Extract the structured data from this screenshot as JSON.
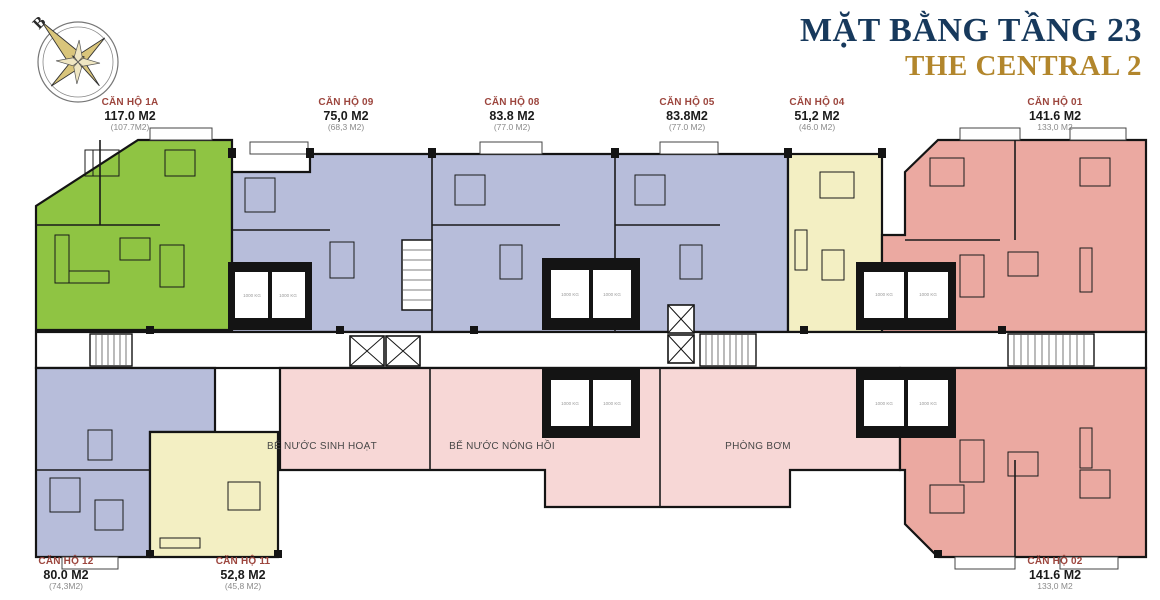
{
  "header": {
    "title": "MẶT BẰNG TẦNG 23",
    "subtitle": "THE CENTRAL 2",
    "title_color": "#17395c",
    "subtitle_color": "#b2862c"
  },
  "compass": {
    "north_label": "B"
  },
  "floor_plan": {
    "elevator_label": "1000 KG",
    "wall_color": "#141414",
    "technical_area_color": "#f7d7d6",
    "apartments": [
      {
        "id": "1A",
        "name": "CĂN HỘ 1A",
        "area": "117.0 M2",
        "area_net": "(107.7M2)",
        "color": "#8fc443"
      },
      {
        "id": "09",
        "name": "CĂN HỘ 09",
        "area": "75,0 M2",
        "area_net": "(68,3 M2)",
        "color": "#b7bdda"
      },
      {
        "id": "08",
        "name": "CĂN HỘ 08",
        "area": "83.8 M2",
        "area_net": "(77.0 M2)",
        "color": "#b7bdda"
      },
      {
        "id": "05",
        "name": "CĂN HỘ 05",
        "area": "83.8M2",
        "area_net": "(77.0 M2)",
        "color": "#b7bdda"
      },
      {
        "id": "04",
        "name": "CĂN HỘ 04",
        "area": "51,2 M2",
        "area_net": "(46.0 M2)",
        "color": "#f3efc3"
      },
      {
        "id": "01",
        "name": "CĂN HỘ 01",
        "area": "141.6 M2",
        "area_net": "133,0 M2",
        "color": "#eba9a1"
      },
      {
        "id": "12",
        "name": "CĂN HỘ 12",
        "area": "80.0 M2",
        "area_net": "(74,3M2)",
        "color": "#b7bdda"
      },
      {
        "id": "11",
        "name": "CĂN HỘ 11",
        "area": "52,8 M2",
        "area_net": "(45,8 M2)",
        "color": "#f3efc3"
      },
      {
        "id": "02",
        "name": "CĂN HỘ 02",
        "area": "141.6 M2",
        "area_net": "133,0 M2",
        "color": "#eba9a1"
      }
    ],
    "technical_rooms": [
      {
        "name": "BỂ NƯỚC SINH HOẠT"
      },
      {
        "name": "BỂ NƯỚC NÓNG HỒI"
      },
      {
        "name": "PHÒNG BƠM"
      }
    ]
  }
}
